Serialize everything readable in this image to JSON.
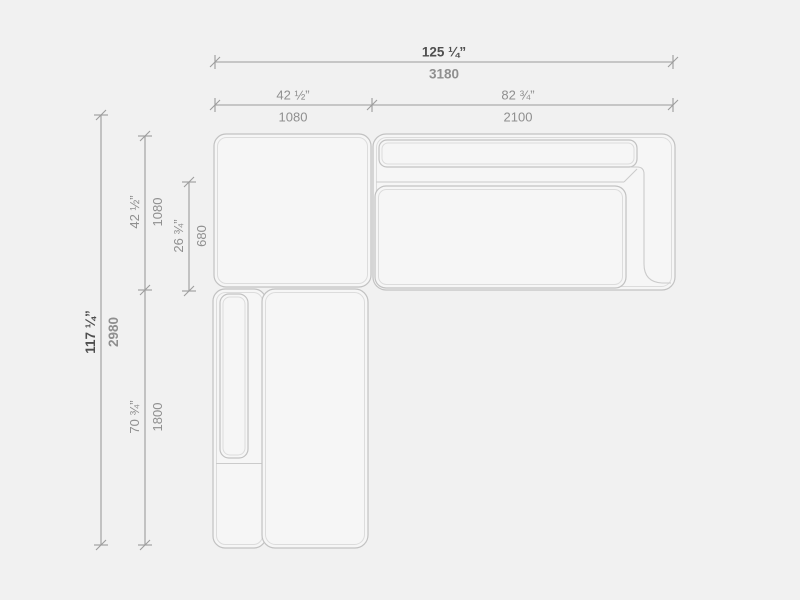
{
  "figure": {
    "type": "furniture-dimension-drawing",
    "subject": "corner sectional sofa, top view plan with dimensions"
  },
  "palette": {
    "background": "#f1f1f1",
    "shape_fill": "#f6f6f6",
    "stroke_outer": "#c2c2c2",
    "stroke_inner": "#dcdcdc",
    "stroke_frame": "#cbcbcb",
    "dim_line": "#9c9c9c",
    "text_dark": "#4f4f4f",
    "text_gray": "#8f8f8f"
  },
  "dimensions": {
    "total_width": {
      "inches": "125 ¼”",
      "mm": "3180"
    },
    "left_width": {
      "inches": "42 ½”",
      "mm": "1080"
    },
    "right_width": {
      "inches": "82 ¾”",
      "mm": "2100"
    },
    "total_depth": {
      "inches": "117 ¼”",
      "mm": "2980"
    },
    "upper_depth": {
      "inches": "42 ½”",
      "mm": "1080"
    },
    "seat_depth": {
      "inches": "26 ¾”",
      "mm": "680"
    },
    "chaise_length": {
      "inches": "70 ¾”",
      "mm": "1800"
    }
  }
}
